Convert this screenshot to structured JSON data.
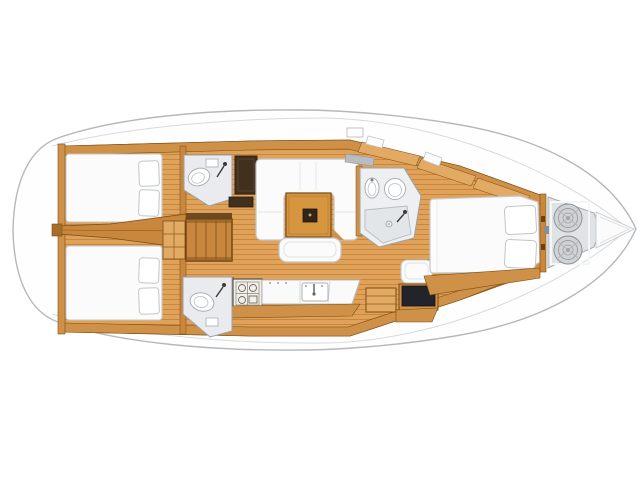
{
  "meta": {
    "subject": "sailing-yacht-interior-floor-plan",
    "view": "top-down",
    "bow_direction": "right",
    "stern_direction": "left"
  },
  "colors": {
    "page_bg": "#ffffff",
    "hull_fill": "#fefefe",
    "hull_stroke": "#b4b8bb",
    "deck_line": "#d7dadc",
    "floor_base": "#dfa258",
    "floor_stripe": "#c4833c",
    "wood_light": "#e2aa62",
    "wood_mid": "#cf9147",
    "wood_deep": "#c9873e",
    "wood_stroke": "#7a4d15",
    "wood_dark_line": "#8a5a1e",
    "dark_cabinet": "#42301f",
    "dark_cabinet_stroke": "#2c1f14",
    "navy_desk": "#23242b",
    "white_furniture": "#fbfbfb",
    "furniture_stroke": "#c2c6c9",
    "seam_gray": "#e3e5e7",
    "bath_floor": "#e9ebee",
    "bath_stroke": "#9aa2a8",
    "fixture_white": "#ffffff",
    "fixture_stroke": "#a8b0b5",
    "shower_floor": "#e2e6e9",
    "locker_fill": "#e0e3e5",
    "rope_fill": "#d0d2d4",
    "rope_stroke": "#94979a",
    "table_wood": "#d6953f",
    "table_center": "#2f2519",
    "stove_fill": "#f2efe9",
    "stove_stroke": "#55504a",
    "hatch_gray": "#b9bdc1"
  },
  "rooms": [
    {
      "id": "aft-cabin-port",
      "features": [
        "double-berth",
        "pillow",
        "pillow"
      ]
    },
    {
      "id": "aft-cabin-starboard",
      "features": [
        "double-berth",
        "pillow",
        "pillow"
      ]
    },
    {
      "id": "aft-head-port",
      "features": [
        "toilet",
        "shower-handle"
      ]
    },
    {
      "id": "aft-head-starboard",
      "features": [
        "toilet",
        "shower-handle"
      ]
    },
    {
      "id": "companionway",
      "features": [
        "stairs",
        "engine-hatch-grid"
      ]
    },
    {
      "id": "saloon",
      "features": [
        "u-shaped-sofa",
        "dining-table",
        "settee-bench",
        "wardrobe"
      ]
    },
    {
      "id": "galley",
      "features": [
        "stove",
        "counter",
        "sink",
        "faucet"
      ]
    },
    {
      "id": "nav-station",
      "features": [
        "seat",
        "chart-table",
        "cabinet"
      ]
    },
    {
      "id": "forward-head",
      "features": [
        "sink",
        "toilet",
        "shower-floor",
        "drain"
      ]
    },
    {
      "id": "forward-cabin",
      "features": [
        "double-berth",
        "pillow",
        "pillow"
      ]
    },
    {
      "id": "anchor-locker",
      "features": [
        "rope-coil",
        "rope-coil"
      ]
    },
    {
      "id": "transom",
      "features": [
        "swim-platform-arcs"
      ]
    }
  ]
}
